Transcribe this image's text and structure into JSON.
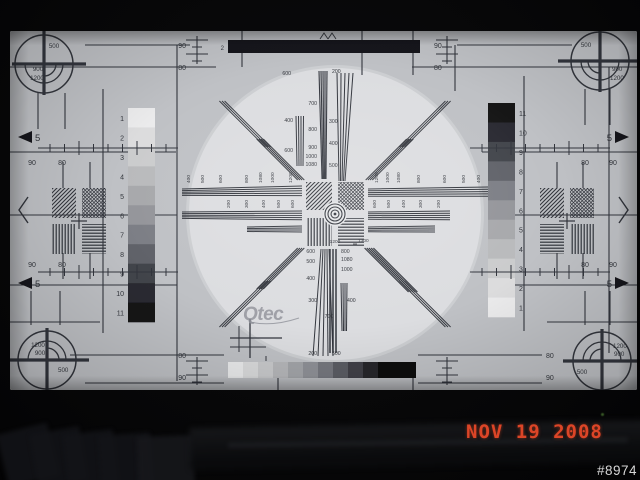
{
  "overlay": {
    "date_stamp": "NOV 19 2008",
    "counter": "#8974"
  },
  "colors": {
    "date_stamp": "#dc4527",
    "counter": "#d6d6d6",
    "screen_bg": "#bfc1c5",
    "circle_fill": "#dcdde0",
    "line": "#33363c",
    "black": "#17181b",
    "logo_gray": "#90929a",
    "grayscale_ramp": [
      "#ebebec",
      "#dcdcdd",
      "#cbcccd",
      "#b9babc",
      "#a7a8ab",
      "#94959a",
      "#7c7e85",
      "#606269",
      "#43454b",
      "#2a2b30",
      "#121316"
    ],
    "bottom_ramp": [
      "#e9eaeb",
      "#d9dadb",
      "#c8c9cb",
      "#b5b6b9",
      "#a2a4a8",
      "#8e9096",
      "#75777e",
      "#5a5c63",
      "#3f4147",
      "#26272b"
    ]
  },
  "pattern": {
    "logo": "Qtec",
    "corner_labels": {
      "tl": [
        "500",
        "900",
        "1200"
      ],
      "tr": [
        "500",
        "900",
        "1200"
      ],
      "bl": [
        "1200",
        "900",
        "500"
      ],
      "br": [
        "1200",
        "900",
        "500"
      ]
    },
    "grayscale_numbers": [
      "1",
      "2",
      "3",
      "4",
      "5",
      "6",
      "7",
      "8",
      "9",
      "10",
      "11"
    ],
    "edge_arrow_label": "5",
    "top_bar_label": "2",
    "level_ninety": "90",
    "level_eighty": "80",
    "wedge_labels": {
      "above_left": [
        "400",
        "600"
      ],
      "above_top_left": "600",
      "above_top_right": "200",
      "above_mid": [
        "700",
        "800",
        "900",
        "1000",
        "1080"
      ],
      "above_right": [
        "300",
        "400",
        "500"
      ],
      "below_left": [
        "600",
        "500",
        "400"
      ],
      "below_right": [
        "800",
        "1080",
        "1000"
      ],
      "below_pair": "1200",
      "below_bottom_left": [
        "300",
        "200"
      ],
      "below_bottom_mid": "700",
      "below_bottom_right": [
        "400",
        "500"
      ],
      "diag": "1300",
      "h_right_1": [
        "1200",
        "1000",
        "1080",
        "800",
        "600",
        "500",
        "400"
      ],
      "h_right_2": [
        "600",
        "500",
        "400",
        "300",
        "200"
      ],
      "h_left_1": [
        "400",
        "500",
        "600",
        "800",
        "1080",
        "1000",
        "1200"
      ],
      "h_left_2": [
        "200",
        "300",
        "400",
        "500",
        "600"
      ]
    }
  }
}
